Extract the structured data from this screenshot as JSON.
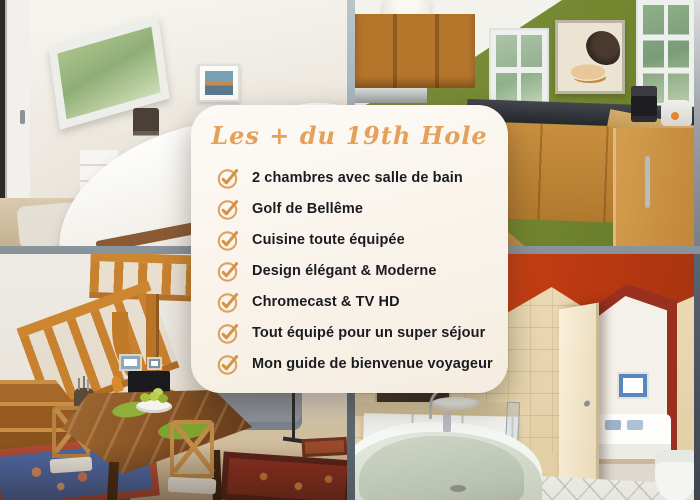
{
  "card": {
    "title": "Les + du 19th Hole",
    "title_color": "#E5A05C",
    "background_color": "#FBF6EE",
    "text_color": "#1B1B22",
    "check_icon": "check-circle-icon",
    "check_color": "#DD9A55",
    "items": [
      "2 chambres avec salle de bain",
      "Golf de Bellême",
      "Cuisine toute équipée",
      "Design élégant & Moderne",
      "Chromecast & TV HD",
      "Tout équipé pour un super séjour",
      "Mon guide de bienvenue voyageur"
    ]
  },
  "photos": {
    "top_left": "attic-bedroom",
    "top_right": "kitchen",
    "bottom_left": "dining-room-staircase",
    "bottom_right": "bathroom"
  }
}
